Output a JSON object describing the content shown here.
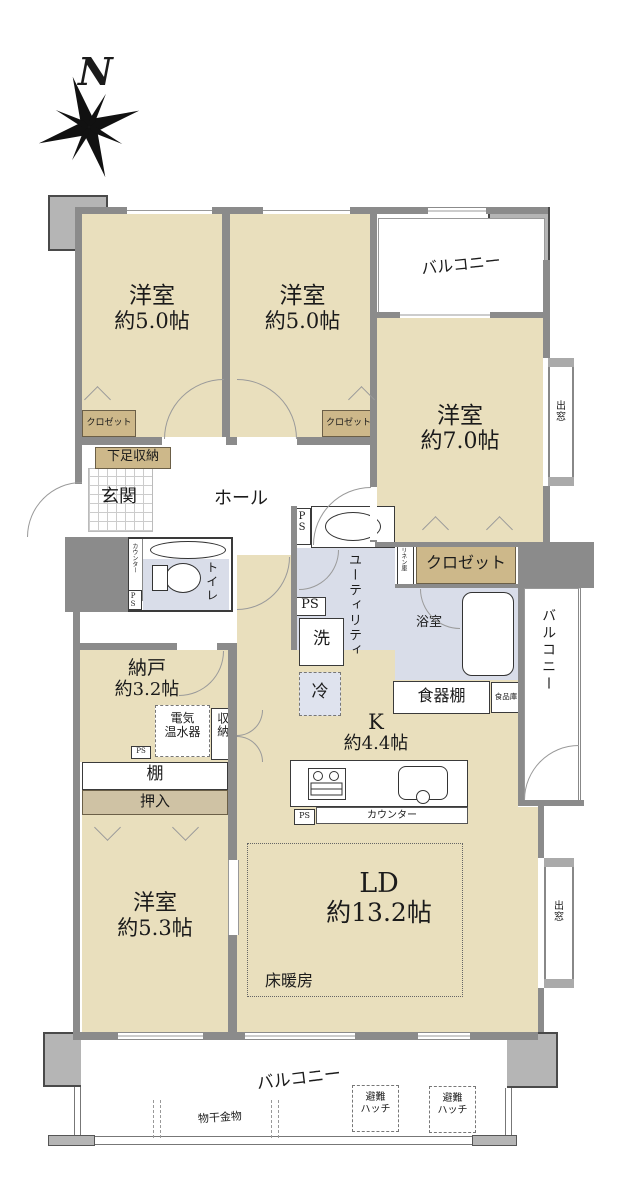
{
  "compass": {
    "north": "N"
  },
  "rooms": {
    "bedroom_a": {
      "name": "洋室",
      "size": "約5.0帖"
    },
    "bedroom_b": {
      "name": "洋室",
      "size": "約5.0帖"
    },
    "bedroom_c": {
      "name": "洋室",
      "size": "約7.0帖"
    },
    "bedroom_d": {
      "name": "洋室",
      "size": "約5.3帖"
    },
    "storage_room": {
      "name": "納戸",
      "size": "約3.2帖"
    },
    "kitchen": {
      "name": "K",
      "size": "約4.4帖"
    },
    "living_dining": {
      "name": "LD",
      "size": "約13.2帖"
    },
    "entrance": "玄関",
    "hall": "ホール",
    "toilet": "トイレ",
    "utility": "ユーティリティ",
    "bathroom": "浴室"
  },
  "balconies": {
    "top": "バルコニー",
    "right": "バルコニー",
    "bottom": "バルコニー"
  },
  "fixtures": {
    "closet_a": "クロゼット",
    "closet_b": "クロゼット",
    "closet_c": "クロゼット",
    "linen": "リネン庫",
    "shoe_storage": "下足収納",
    "toilet_counter": "カウンター",
    "washer": "洗",
    "fridge": "冷",
    "cupboard": "食器棚",
    "pantry": "食品庫",
    "water_heater": [
      "電気",
      "温水器"
    ],
    "storage": "収納",
    "shelf": "棚",
    "futon_closet": "押入",
    "kitchen_counter": "カウンター",
    "floor_heating": "床暖房",
    "bay_window_top": "出窓",
    "bay_window_bottom": "出窓",
    "escape_hatch": [
      "避難",
      "ハッチ"
    ],
    "laundry_hardware": "物干金物",
    "pipe_space": "PS"
  },
  "colors": {
    "room_fill": "#e9dfbd",
    "wet_fill": "#d9dde9",
    "closet_fill": "#cdb88a",
    "oshiire_fill": "#cfc2a4",
    "wall": "#8b8b8b",
    "pillar": "#b5b5b5"
  }
}
